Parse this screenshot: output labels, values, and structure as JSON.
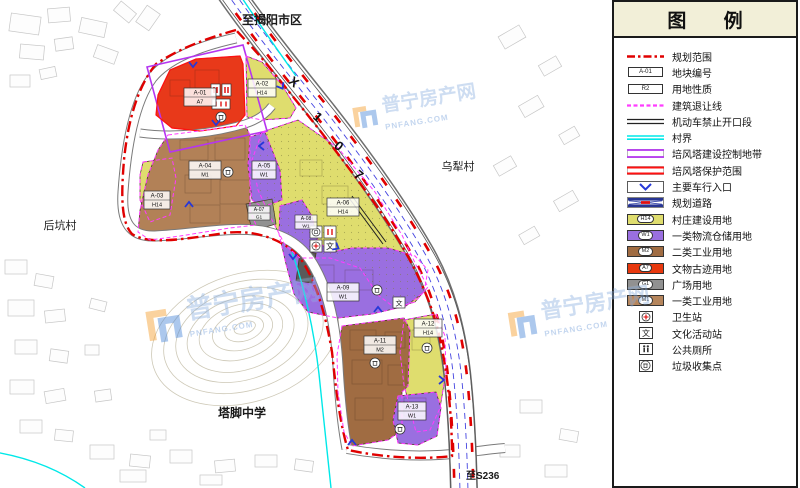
{
  "legend": {
    "title": "图  例",
    "items": [
      {
        "label": "规划范围"
      },
      {
        "label": "地块编号",
        "code": "A-01"
      },
      {
        "label": "用地性质",
        "code": "R2"
      },
      {
        "label": "建筑退让线"
      },
      {
        "label": "机动车禁止开口段"
      },
      {
        "label": "村界"
      },
      {
        "label": "培风塔建设控制地带"
      },
      {
        "label": "培风塔保护范围"
      },
      {
        "label": "主要车行入口"
      },
      {
        "label": "规划道路"
      },
      {
        "label": "村庄建设用地",
        "code": "H14",
        "color": "#DFDD6E"
      },
      {
        "label": "一类物流仓储用地",
        "code": "W1",
        "color": "#9A6FE0"
      },
      {
        "label": "二类工业用地",
        "code": "M2",
        "color": "#A06C42"
      },
      {
        "label": "文物古迹用地",
        "code": "A7",
        "color": "#E8380E"
      },
      {
        "label": "广场用地",
        "code": "G1",
        "color": "#919191"
      },
      {
        "label": "一类工业用地",
        "code": "M1",
        "color": "#B5855C"
      },
      {
        "label": "卫生站"
      },
      {
        "label": "文化活动站"
      },
      {
        "label": "公共厕所"
      },
      {
        "label": "垃圾收集点"
      }
    ]
  },
  "map": {
    "places": {
      "north": "至揭阳市区",
      "east": "乌犁村",
      "west": "后坑村",
      "school": "塔脚中学",
      "south": "至S236"
    },
    "road_label": {
      "c1": "X",
      "c2": "1",
      "c3": "0",
      "c4": "7"
    },
    "plots": [
      {
        "id": "A-01",
        "code": "A7"
      },
      {
        "id": "A-02",
        "code": "H14"
      },
      {
        "id": "A-03",
        "code": "H14"
      },
      {
        "id": "A-04",
        "code": "M1"
      },
      {
        "id": "A-05",
        "code": "W1"
      },
      {
        "id": "A-06",
        "code": "H14"
      },
      {
        "id": "A-07",
        "code": "G1"
      },
      {
        "id": "A-08",
        "code": "W1"
      },
      {
        "id": "A-09",
        "code": "W1"
      },
      {
        "id": "A-11",
        "code": "M2"
      },
      {
        "id": "A-12",
        "code": "H14"
      },
      {
        "id": "A-13",
        "code": "W1"
      }
    ]
  },
  "watermark": {
    "text": "普宁房产网",
    "site": "PNFANG.COM"
  }
}
